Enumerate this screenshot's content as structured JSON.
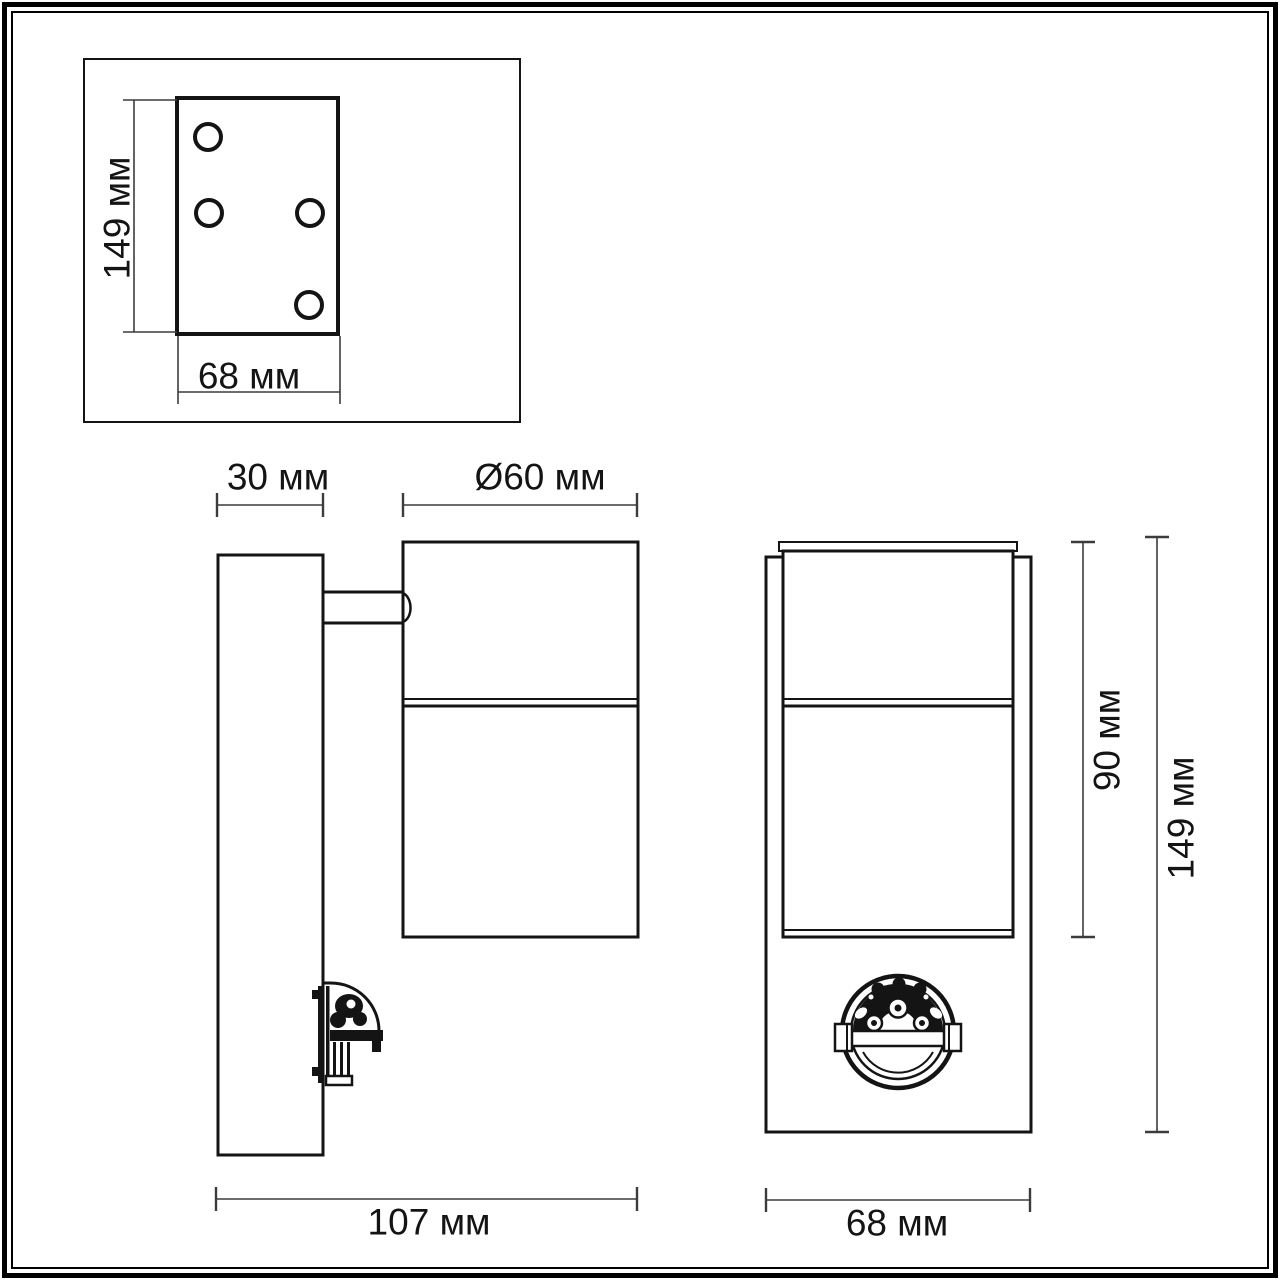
{
  "figure": {
    "type": "technical-drawing",
    "unit": "мм",
    "colors": {
      "line": "#141414",
      "dimension_line": "#3c3c3c",
      "background": "#ffffff"
    }
  },
  "mounting_plate_view": {
    "height_label": "149 мм",
    "width_label": "68 мм",
    "hole_count": 4
  },
  "side_view": {
    "wall_plate_depth_label": "30 мм",
    "diameter_label": "Ø60 мм",
    "overall_depth_label": "107 мм"
  },
  "front_view": {
    "lamp_height_label": "90 мм",
    "overall_height_label": "149 мм",
    "width_label": "68 мм"
  }
}
